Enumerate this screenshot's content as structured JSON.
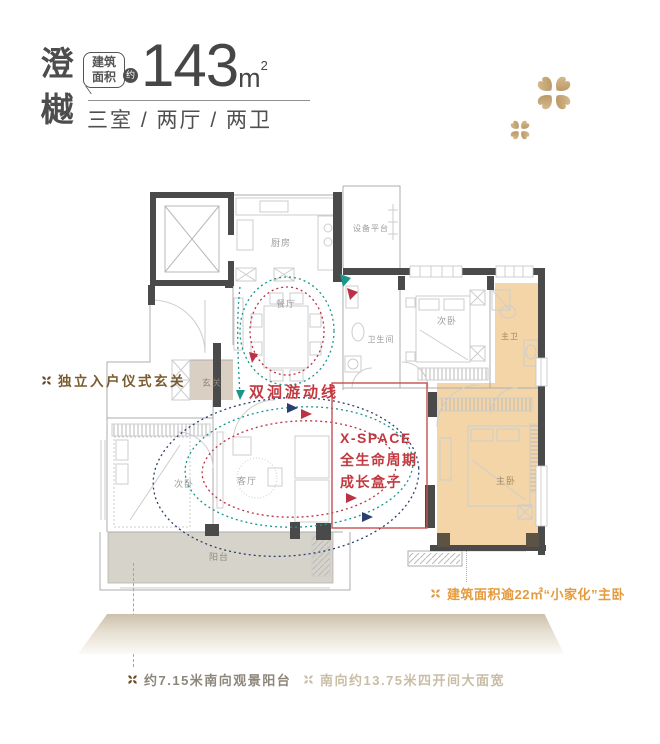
{
  "header": {
    "project_name": "澄樾",
    "area_badge_top": "建筑",
    "area_badge_bottom": "面积",
    "approx": "约",
    "area_value": "143",
    "area_unit": "m",
    "area_unit_exp": "2",
    "layout_spec": "三室 / 两厅 / 两卫"
  },
  "floor_plan": {
    "rooms": {
      "kitchen": "厨房",
      "equipment_platform": "设备平台",
      "dining": "餐厅",
      "bathroom": "卫生间",
      "bedroom2": "次卧",
      "master_bathroom": "主卫",
      "foyer": "玄关",
      "bedroom3": "次卧",
      "living": "客厅",
      "master_bedroom": "主卧",
      "balcony": "阳台"
    },
    "circulation_label": "双洄游动线",
    "xspace_line1": "X-SPACE",
    "xspace_line2": "全生命周期",
    "xspace_line3": "成长盒子"
  },
  "annotations": {
    "foyer": "独立入户仪式玄关",
    "master_bedroom": "建筑面积逾22㎡“小家化”主卧",
    "balcony": "约7.15米南向观景阳台",
    "bay_width": "南向约13.75米四开间大面宽"
  },
  "colors": {
    "accent_red": "#c2383f",
    "teal": "#1a968a",
    "navy": "#2a3f6d",
    "highlight_tan": "#f3d5a7",
    "foyer_beige": "#d9cfc2",
    "balcony_gray": "#d6d3cb",
    "gold": "#c9a873",
    "wall_dark": "#4a4a4a",
    "annotation_orange": "#e59a3d",
    "annotation_brown": "#7a5a2e"
  }
}
